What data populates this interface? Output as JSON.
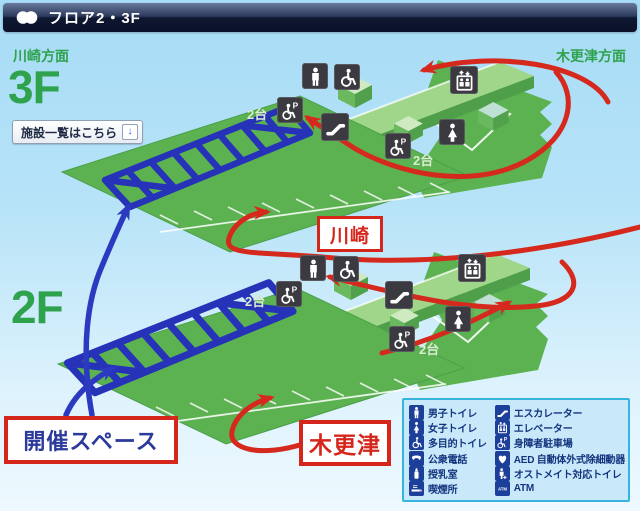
{
  "header": {
    "title": "フロア2・3F"
  },
  "directions": {
    "left": "川崎方面",
    "right": "木更津方面"
  },
  "floors": {
    "upper": "3F",
    "lower": "2F"
  },
  "facility_button": {
    "label": "施設一覧はこちら",
    "arrow": "↓"
  },
  "map_labels": {
    "kawasaki": "川崎",
    "kisarazu": "木更津",
    "event_space": "開催スペース"
  },
  "badges": {
    "f3_left": "2台",
    "f3_right": "2台",
    "f2_left": "2台",
    "f2_right": "2台"
  },
  "legend": {
    "left": [
      {
        "icon": "man-icon",
        "label": "男子トイレ"
      },
      {
        "icon": "woman-icon",
        "label": "女子トイレ"
      },
      {
        "icon": "wheelchair-icon",
        "label": "多目的トイレ"
      },
      {
        "icon": "phone-icon",
        "label": "公衆電話"
      },
      {
        "icon": "nursing-room-icon",
        "label": "授乳室"
      },
      {
        "icon": "smoking-icon",
        "label": "喫煙所"
      }
    ],
    "right": [
      {
        "icon": "escalator-icon",
        "label": "エスカレーター"
      },
      {
        "icon": "elevator-icon",
        "label": "エレベーター"
      },
      {
        "icon": "disabled-parking-icon",
        "label": "身障者駐車場"
      },
      {
        "icon": "aed-icon",
        "label": "AED 自動体外式除細動器"
      },
      {
        "icon": "ostomate-icon",
        "label": "オストメイト対応トイレ"
      },
      {
        "icon": "atm-icon",
        "label": "ATM"
      }
    ]
  },
  "icons": {
    "atm_text": "ATM",
    "parking_letter": "P"
  },
  "colors": {
    "accent_green": "#2fa24d",
    "map_green": "#5cb251",
    "route_red": "#d6291d",
    "route_blue": "#2b3ac0",
    "structure_blue": "#2633b8",
    "legend_navy": "#1c3f9a",
    "label_red": "#d5261c",
    "legend_border": "#35b5de"
  }
}
